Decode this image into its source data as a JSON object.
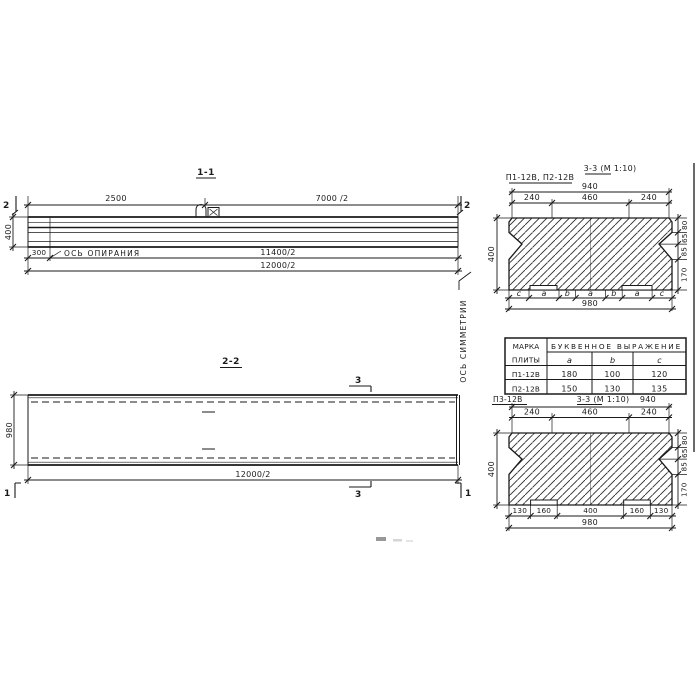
{
  "drawing": {
    "section_1_1": {
      "title": "1-1",
      "section_marker": "2",
      "dim_left_span": "2500",
      "dim_right_span": "7000 /2",
      "dim_height": "400",
      "dim_support_offset": "300",
      "support_axis_label": "ОСЬ ОПИРАНИЯ",
      "dim_span_to_support": "11400/2",
      "dim_overall": "12000/2"
    },
    "symmetry_axis_label": "ОСЬ СИММЕТРИИ",
    "section_2_2": {
      "title": "2-2",
      "cut_marker_3": "3",
      "cut_marker_1": "1",
      "dim_width": "980",
      "dim_overall": "12000/2"
    },
    "section_3_3_p12": {
      "label": "П1-12В, П2-12В",
      "title": "3-3 (М 1:10)",
      "dim_top_overall": "940",
      "dims_top": [
        "240",
        "460",
        "240"
      ],
      "dim_height": "400",
      "dims_right": [
        "80",
        "65",
        "85",
        "170"
      ],
      "letters": [
        "c",
        "a",
        "b",
        "a",
        "b",
        "a",
        "c"
      ],
      "dim_bottom_overall": "980"
    },
    "parameters_table": {
      "header_mark_line1": "МАРКА",
      "header_mark_line2": "ПЛИТЫ",
      "header_expression": "БУКВЕННОЕ ВЫРАЖЕНИЕ",
      "columns": [
        "a",
        "b",
        "c"
      ],
      "rows": [
        {
          "mark": "П1-12В",
          "a": "180",
          "b": "100",
          "c": "120"
        },
        {
          "mark": "П2-12В",
          "a": "150",
          "b": "130",
          "c": "135"
        }
      ]
    },
    "section_3_3_p3": {
      "label": "П3-12В",
      "title": "3-3 (М 1:10)",
      "dim_top_overall": "940",
      "dims_top": [
        "240",
        "460",
        "240"
      ],
      "dim_height": "400",
      "dims_right": [
        "80",
        "65",
        "85",
        "170"
      ],
      "dims_bottom": [
        "130",
        "160",
        "400",
        "160",
        "130"
      ],
      "dim_bottom_overall": "980"
    }
  },
  "colors": {
    "ink": "#1a1a1a",
    "paper": "#ffffff"
  }
}
